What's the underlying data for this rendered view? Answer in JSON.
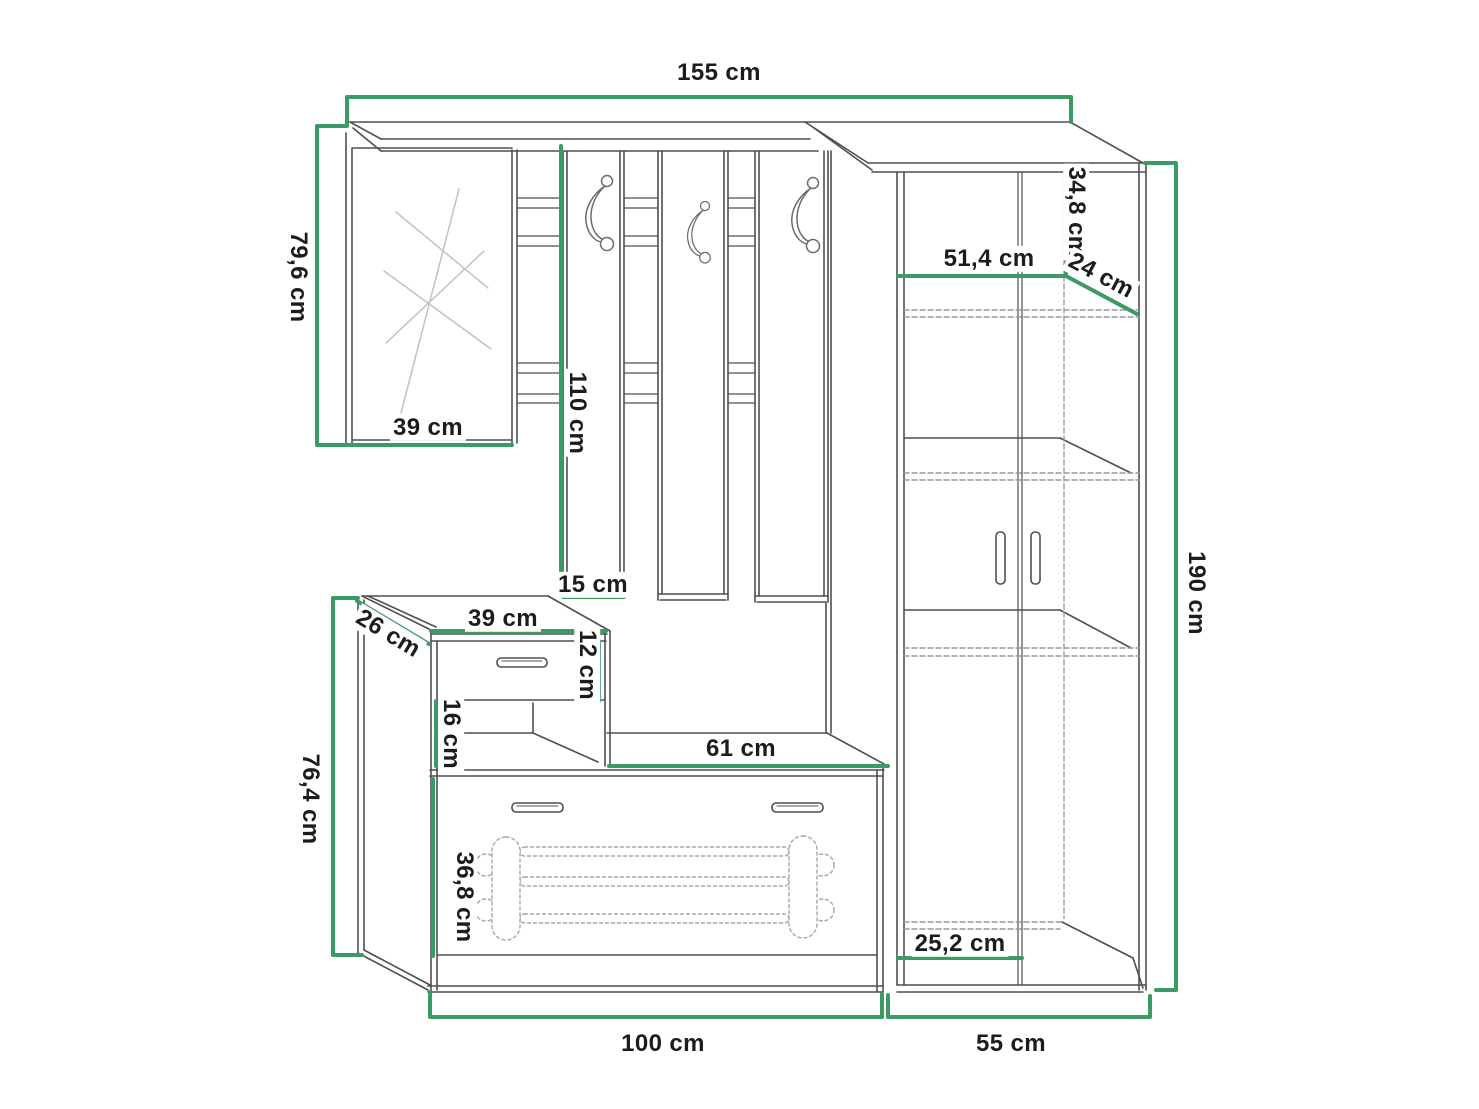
{
  "colors": {
    "dimension_green": "#3c9a64",
    "outline_gray": "#4f4f4f",
    "hatch_gray": "#c2c2c2",
    "dashed_gray": "#999999",
    "text": "#1c1c1c",
    "background": "#ffffff"
  },
  "labels": {
    "total_width": {
      "text": "155 cm"
    },
    "upper_left_height": {
      "text": "79,6 cm"
    },
    "mirror_width": {
      "text": "39 cm"
    },
    "hook_panel_height": {
      "text": "110 cm"
    },
    "hook_panel_width": {
      "text": "15 cm"
    },
    "cabinet_top_offset": {
      "text": "34,8 cm"
    },
    "cabinet_inner_width": {
      "text": "51,4 cm"
    },
    "cabinet_top_depth": {
      "text": "24 cm"
    },
    "cabinet_height": {
      "text": "190 cm"
    },
    "box_depth": {
      "text": "26 cm"
    },
    "box_width": {
      "text": "39 cm"
    },
    "drawer_height": {
      "text": "12 cm"
    },
    "open_shelf_height": {
      "text": "16 cm"
    },
    "bench_top_width": {
      "text": "61 cm"
    },
    "bench_height": {
      "text": "76,4 cm"
    },
    "flap_height": {
      "text": "36,8 cm"
    },
    "bench_width": {
      "text": "100 cm"
    },
    "bottom_shelf_depth": {
      "text": "25,2 cm"
    },
    "cabinet_width": {
      "text": "55 cm"
    }
  }
}
